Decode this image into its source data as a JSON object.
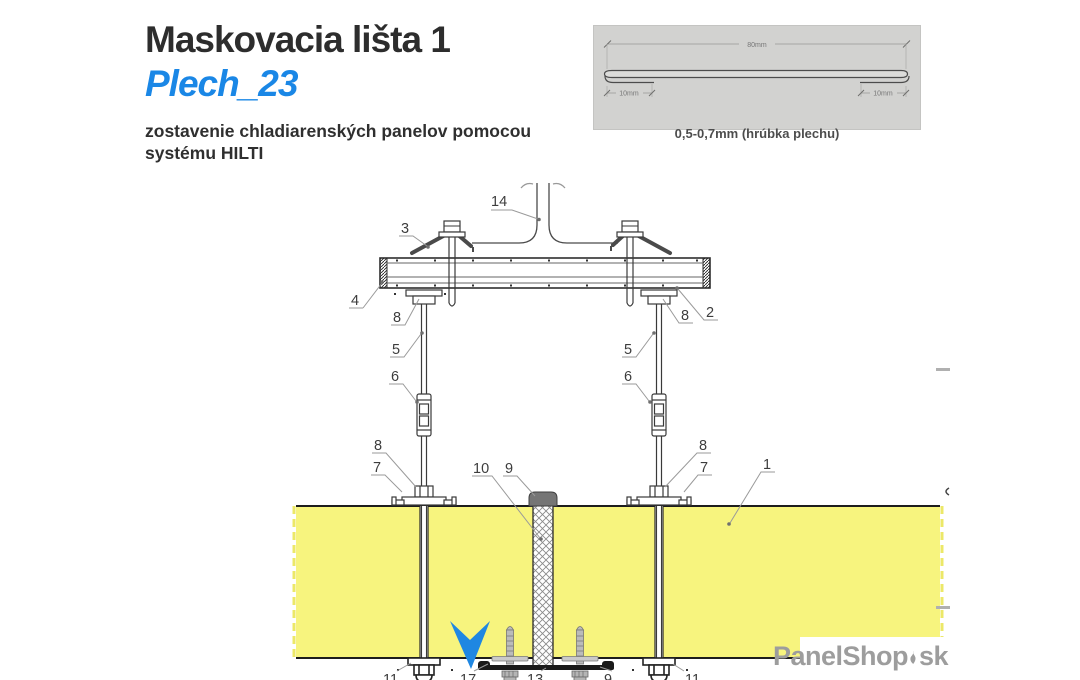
{
  "header": {
    "title": "Maskovacia lišta 1",
    "subtitle": "Plech_23",
    "description_line1": "zostavenie chladiarenských panelov pomocou",
    "description_line2": "systému HILTI"
  },
  "detail_inset": {
    "dim_total": "80mm",
    "dim_left": "10mm",
    "dim_right": "10mm",
    "caption": "0,5-0,7mm (hrúbka plechu)"
  },
  "drawing": {
    "callouts": [
      {
        "label": "14"
      },
      {
        "label": "3"
      },
      {
        "label": "4"
      },
      {
        "label": "8"
      },
      {
        "label": "2"
      },
      {
        "label": "8"
      },
      {
        "label": "5"
      },
      {
        "label": "5"
      },
      {
        "label": "6"
      },
      {
        "label": "6"
      },
      {
        "label": "8"
      },
      {
        "label": "7"
      },
      {
        "label": "8"
      },
      {
        "label": "7"
      },
      {
        "label": "10"
      },
      {
        "label": "9"
      },
      {
        "label": "1"
      },
      {
        "label": "11"
      },
      {
        "label": "17"
      },
      {
        "label": "13"
      },
      {
        "label": "9"
      },
      {
        "label": "11"
      }
    ]
  },
  "watermark": {
    "name": "PanelShop",
    "tld": "sk"
  },
  "colors": {
    "accent_blue": "#1a87e6",
    "panel_yellow": "#f7f47e",
    "inset_gray": "#d2d2d0",
    "arrow_blue": "#1f87e2",
    "watermark_gray": "#9d9d9d"
  }
}
